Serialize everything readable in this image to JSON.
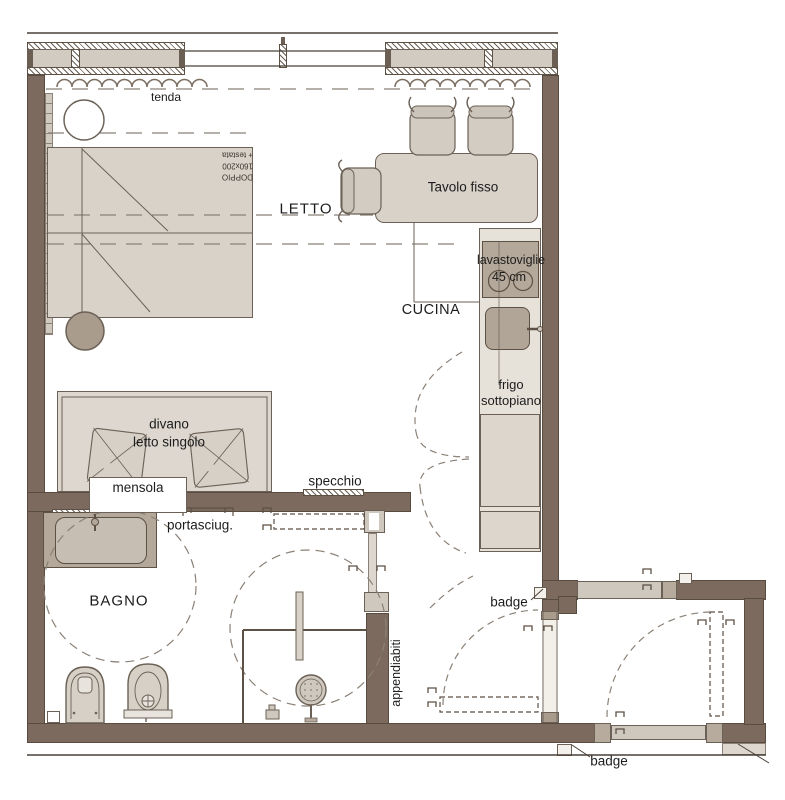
{
  "plan": {
    "rooms": {
      "bedroom": "LETTO",
      "kitchen": "CUCINA",
      "bathroom": "BAGNO"
    },
    "furniture": {
      "curtain": "tenda",
      "table": "Tavolo fisso",
      "dishwasher": "lavastoviglie",
      "dishwasher_size": "45 cm",
      "fridge_line1": "frigo",
      "fridge_line2": "sottopiano",
      "sofa_line1": "divano",
      "sofa_line2": "letto singolo",
      "shelf": "mensola",
      "mirror": "specchio",
      "towel_holder": "portasciug.",
      "coat_rack": "appendiabiti",
      "bed_line1": "DOPPIO",
      "bed_line2": "160x200",
      "bed_line3": "+ testata"
    },
    "doors": {
      "badge_top": "badge",
      "badge_bottom": "badge"
    },
    "colors": {
      "wall": "#7b6a5d",
      "furniture_fill": "#d8d2c9",
      "appliance_fill": "#b3a899",
      "outline": "#6b6156",
      "dash": "#8b8177",
      "background": "#ffffff"
    }
  }
}
